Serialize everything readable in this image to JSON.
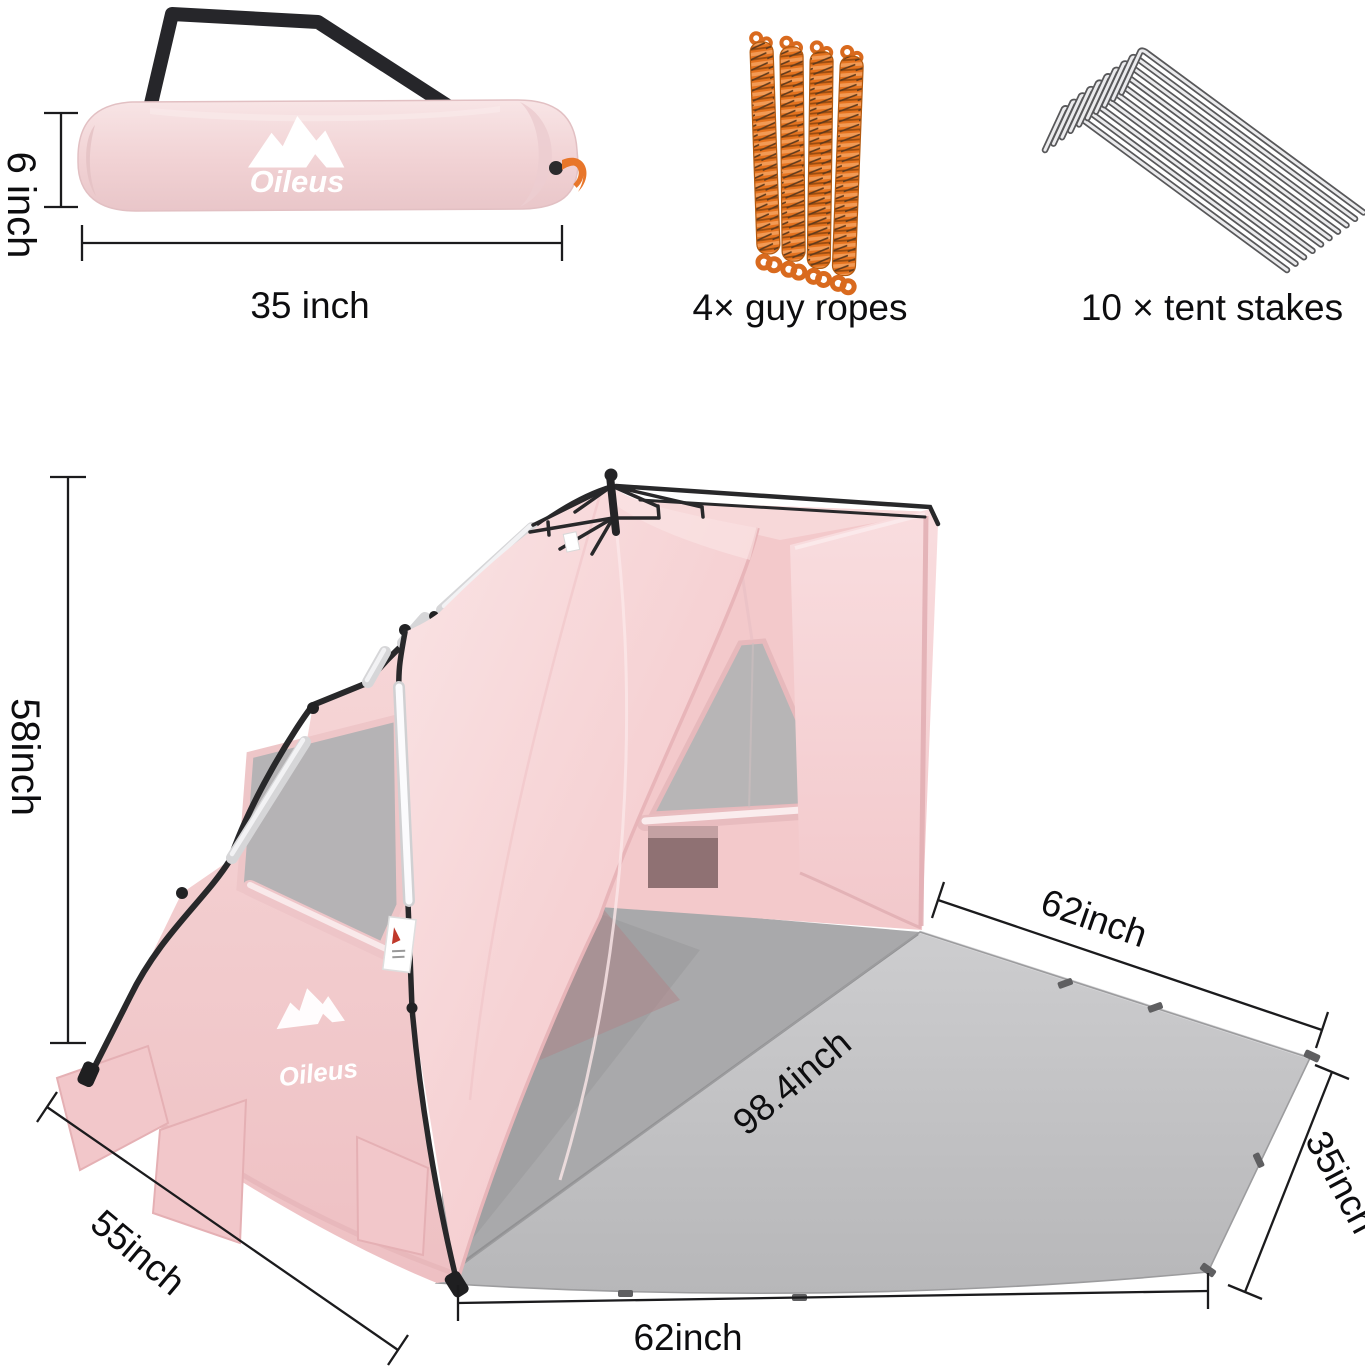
{
  "figure": {
    "brand": {
      "name": "Oileus"
    },
    "carry_bag": {
      "height_label": "6 inch",
      "width_label": "35 inch",
      "bag_color": "#f2d4d6",
      "strap_color": "#26262a",
      "toggle_color": "#e8762a"
    },
    "guy_ropes": {
      "label": "4× guy ropes",
      "count": 4,
      "rope_color": "#e5731f"
    },
    "tent_stakes": {
      "label": "10 × tent stakes",
      "count": 10,
      "stake_color": "#ebebed"
    },
    "tent": {
      "height_label": "58inch",
      "side_label": "55inch",
      "back_width_label": "62inch",
      "diagonal_label": "98.4inch",
      "floor_depth_label": "35inch",
      "front_width_label": "62inch",
      "fabric_color": "#f6d2d4",
      "floor_color": "#c4c4c6",
      "mesh_color": "#b7b5b6"
    }
  }
}
